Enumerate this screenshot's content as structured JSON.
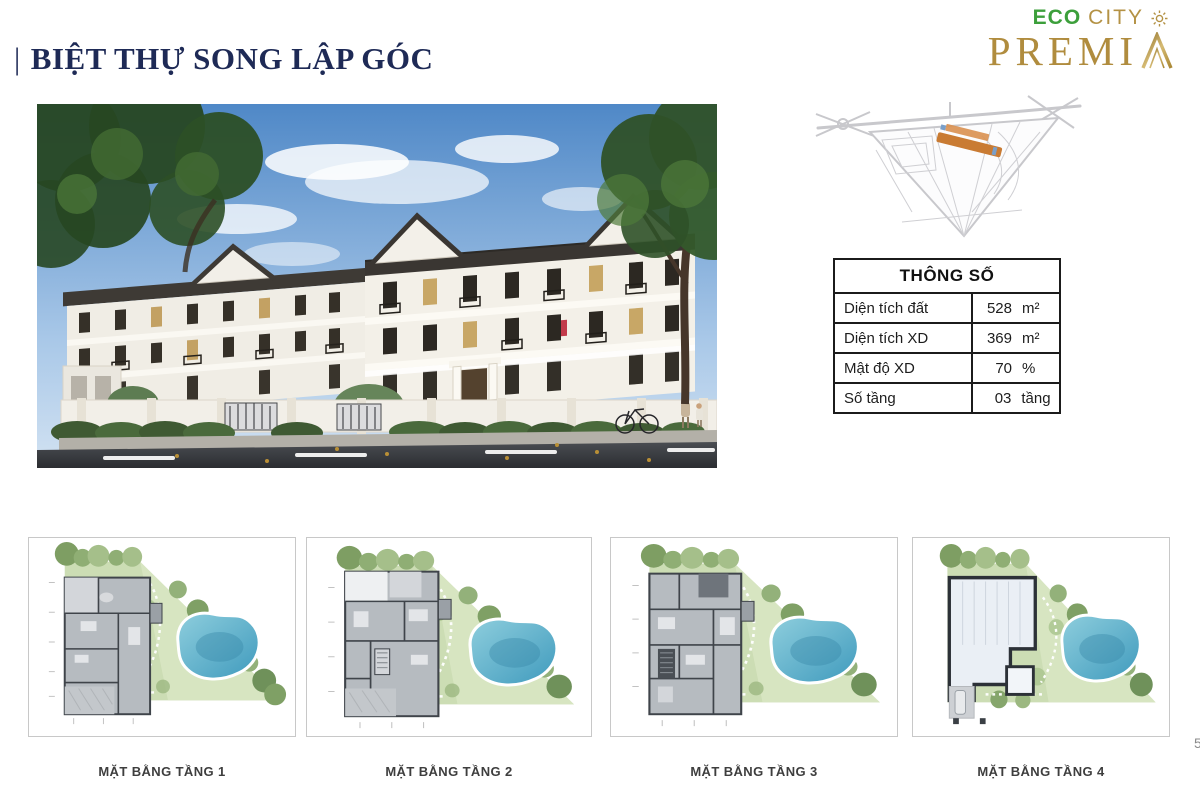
{
  "page": {
    "background": "#ffffff",
    "page_number_fragment": "5"
  },
  "header": {
    "title_prefix": "|",
    "title": "BIỆT THỰ SONG LẬP GÓC",
    "title_color": "#1e2a56"
  },
  "logo": {
    "eco": "ECO",
    "city": "CITY",
    "wordmark": "PREMIA",
    "wordmark_prefix": "PREMI",
    "eco_color": "#3c9f3b",
    "gold_color": "#b08c3e",
    "sun_icon_glyph": "✳"
  },
  "site_map": {
    "highlight_color": "#c97b33",
    "road_color": "#c8c8cc"
  },
  "specs": {
    "title": "THÔNG SỐ",
    "rows": [
      {
        "label": "Diện tích đất",
        "value": "528",
        "unit": "m²"
      },
      {
        "label": "Diện tích XD",
        "value": "369",
        "unit": "m²"
      },
      {
        "label": "Mật độ XD",
        "value": "70",
        "unit": "%"
      },
      {
        "label": "Số tầng",
        "value": "03",
        "unit": "tầng"
      }
    ]
  },
  "floor_plans": {
    "garden_color": "#ccddb4",
    "pool_color": "#4aa3c2",
    "items": [
      {
        "label": "MẶT BẰNG TẦNG 1"
      },
      {
        "label": "MẶT BẰNG TẦNG 2"
      },
      {
        "label": "MẶT BẰNG TẦNG 3"
      },
      {
        "label": "MẶT BẰNG TẦNG 4"
      }
    ]
  }
}
